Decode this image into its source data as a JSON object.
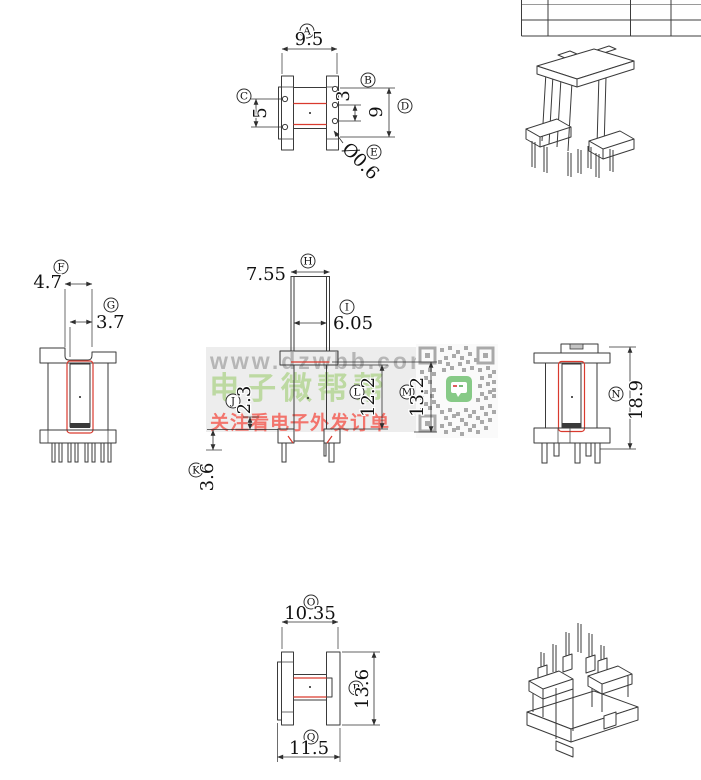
{
  "page": {
    "background": "#ffffff"
  },
  "watermark": {
    "url": "www.dzwbb.com",
    "brand": "电子微帮帮",
    "slogan": "关注看电子外发订单",
    "url_color": "#b6b6b6",
    "brand_color": "#bdd9a2",
    "slogan_color": "#f2746c"
  },
  "drawing": {
    "line_color": "#3a3a3a",
    "highlight_color": "#d93a2e",
    "dims": {
      "A": {
        "id": "A",
        "value": "9.5"
      },
      "B": {
        "id": "B",
        "value": "3"
      },
      "C": {
        "id": "C",
        "value": "5"
      },
      "D": {
        "id": "D",
        "value": "9"
      },
      "E": {
        "id": "E",
        "value": "Ø0.6"
      },
      "F": {
        "id": "F",
        "value": "4.7"
      },
      "G": {
        "id": "G",
        "value": "3.7"
      },
      "H": {
        "id": "H",
        "value": "7.55"
      },
      "I": {
        "id": "I",
        "value": "6.05"
      },
      "J": {
        "id": "J",
        "value": "2.3"
      },
      "K": {
        "id": "K",
        "value": "3.6"
      },
      "L": {
        "id": "L",
        "value": "12.2"
      },
      "M": {
        "id": "M",
        "value": "13.2"
      },
      "N": {
        "id": "N",
        "value": "18.9"
      },
      "O": {
        "id": "O",
        "value": "10.35"
      },
      "P": {
        "id": "P",
        "value": "13.6"
      },
      "Q": {
        "id": "Q",
        "value": "11.5"
      }
    }
  }
}
